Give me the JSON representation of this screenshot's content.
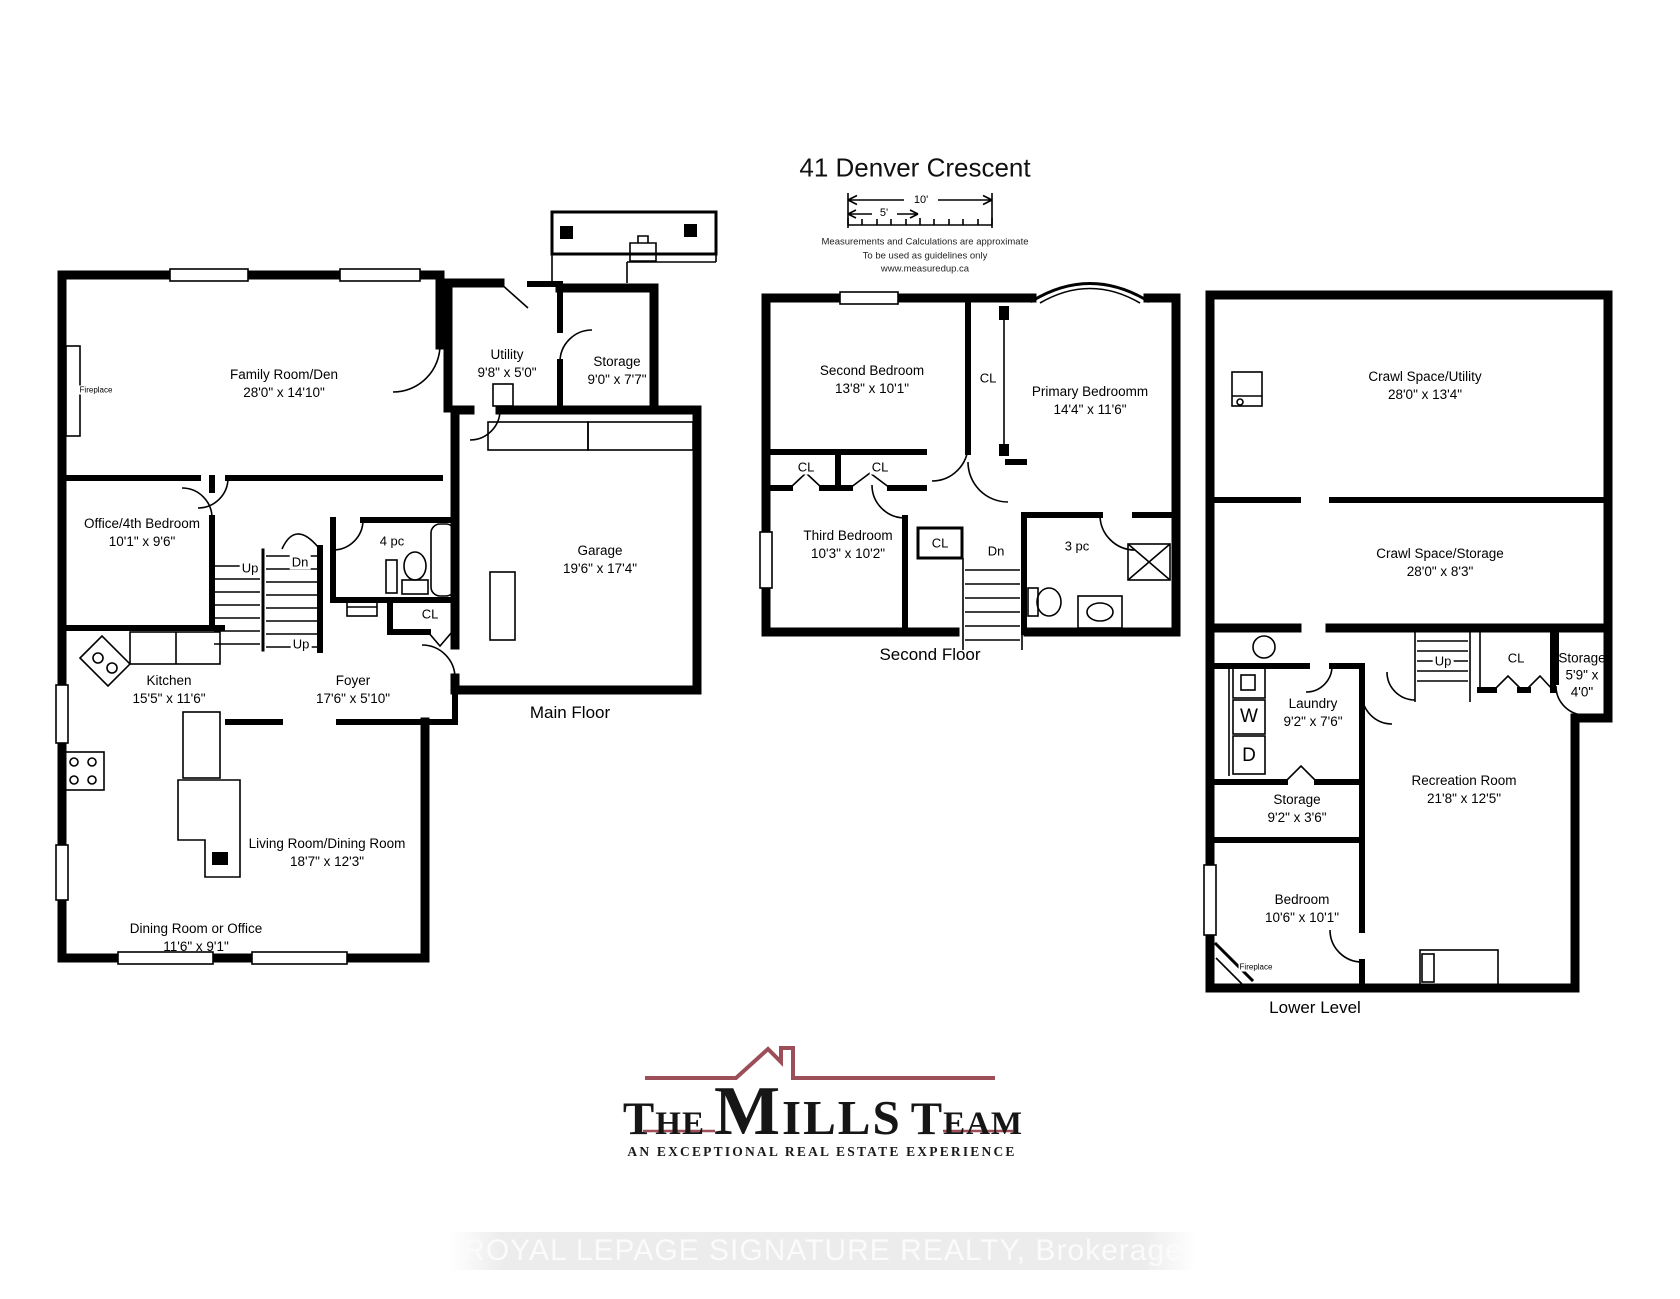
{
  "title": "41 Denver Crescent",
  "scale_bar": {
    "ten_label": "10'",
    "five_label": "5'"
  },
  "disclaimer": {
    "line1": "Measurements and Calculations are approximate",
    "line2": "To be used as guidelines only",
    "line3": "www.measuredup.ca"
  },
  "floors": {
    "main": {
      "caption": "Main Floor",
      "rooms": {
        "family": {
          "name": "Family Room/Den",
          "dims": "28'0\" x 14'10\""
        },
        "office": {
          "name": "Office/4th Bedroom",
          "dims": "10'1\" x 9'6\""
        },
        "utility": {
          "name": "Utility",
          "dims": "9'8\" x 5'0\""
        },
        "storage": {
          "name": "Storage",
          "dims": "9'0\" x 7'7\""
        },
        "garage": {
          "name": "Garage",
          "dims": "19'6\" x 17'4\""
        },
        "kitchen": {
          "name": "Kitchen",
          "dims": "15'5\" x 11'6\""
        },
        "foyer": {
          "name": "Foyer",
          "dims": "17'6\" x 5'10\""
        },
        "living": {
          "name": "Living Room/Dining Room",
          "dims": "18'7\" x 12'3\""
        },
        "dining": {
          "name": "Dining Room or Office",
          "dims": "11'6\" x 9'1\""
        }
      },
      "labels": {
        "bath": "4 pc",
        "up1": "Up",
        "dn": "Dn",
        "up2": "Up",
        "cl": "CL",
        "fireplace": "Fireplace"
      }
    },
    "second": {
      "caption": "Second Floor",
      "rooms": {
        "second_bedroom": {
          "name": "Second Bedroom",
          "dims": "13'8\" x 10'1\""
        },
        "primary_bedroom": {
          "name": "Primary Bedroomm",
          "dims": "14'4\" x 11'6\""
        },
        "third_bedroom": {
          "name": "Third Bedroom",
          "dims": "10'3\" x 10'2\""
        }
      },
      "labels": {
        "cl_corridor": "CL",
        "cl1": "CL",
        "cl2": "CL",
        "cl3": "CL",
        "dn": "Dn",
        "bath": "3 pc"
      }
    },
    "lower": {
      "caption": "Lower Level",
      "rooms": {
        "crawl_utility": {
          "name": "Crawl Space/Utility",
          "dims": "28'0\" x 13'4\""
        },
        "crawl_storage": {
          "name": "Crawl Space/Storage",
          "dims": "28'0\" x 8'3\""
        },
        "laundry": {
          "name": "Laundry",
          "dims": "9'2\" x 7'6\""
        },
        "storage_right": {
          "name": "Storage",
          "dims": "5'9\" x 4'0\""
        },
        "storage_left": {
          "name": "Storage",
          "dims": "9'2\" x 3'6\""
        },
        "recreation": {
          "name": "Recreation Room",
          "dims": "21'8\" x 12'5\""
        },
        "bedroom": {
          "name": "Bedroom",
          "dims": "10'6\" x 10'1\""
        }
      },
      "labels": {
        "up": "Up",
        "cl": "CL",
        "washer": "W",
        "dryer": "D",
        "fireplace": "Fireplace"
      }
    }
  },
  "branding": {
    "word1": "The",
    "word2": "Mills",
    "word3": "Team",
    "tagline": "AN EXCEPTIONAL REAL ESTATE EXPERIENCE",
    "watermark": "ROYAL LEPAGE SIGNATURE REALTY, Brokerage",
    "accent_color": "#9c4f58"
  }
}
